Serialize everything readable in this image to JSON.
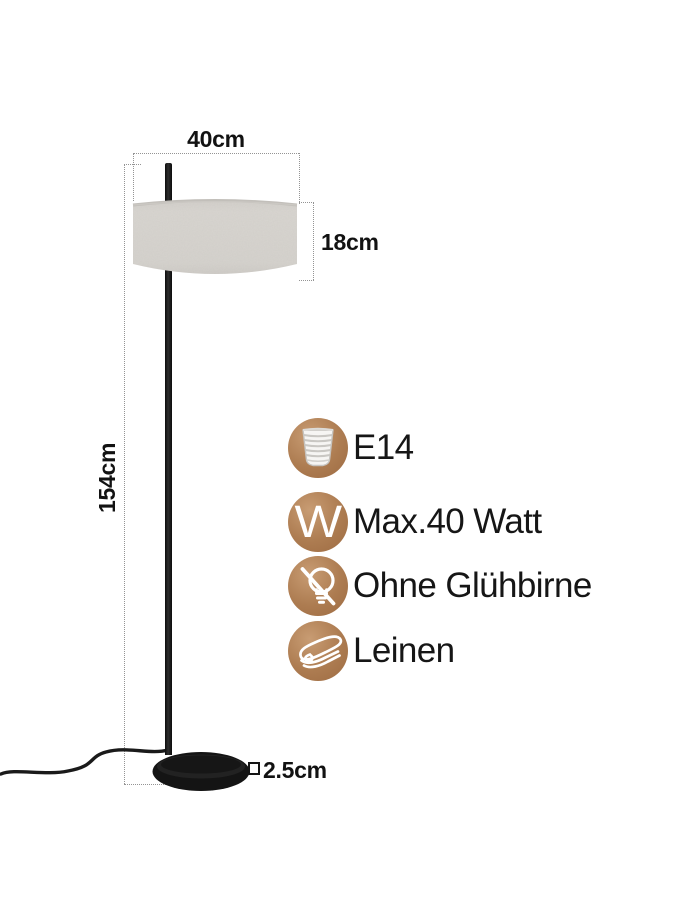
{
  "dimensions": {
    "width": "40cm",
    "shade_height": "18cm",
    "total_height": "154cm",
    "base_thickness": "2.5cm"
  },
  "features": [
    {
      "icon": "e14-socket-icon",
      "label": "E14"
    },
    {
      "icon": "watt-icon",
      "icon_letter": "W",
      "label": "Max.40 Watt"
    },
    {
      "icon": "no-bulb-icon",
      "label": "Ohne Glühbirne"
    },
    {
      "icon": "linen-icon",
      "label": "Leinen"
    }
  ],
  "colors": {
    "accent_copper": "#ad7c51",
    "shade_fabric": "#d8d5d0",
    "lamp_black": "#151515",
    "dimension_line": "#949494",
    "text": "#161616"
  }
}
